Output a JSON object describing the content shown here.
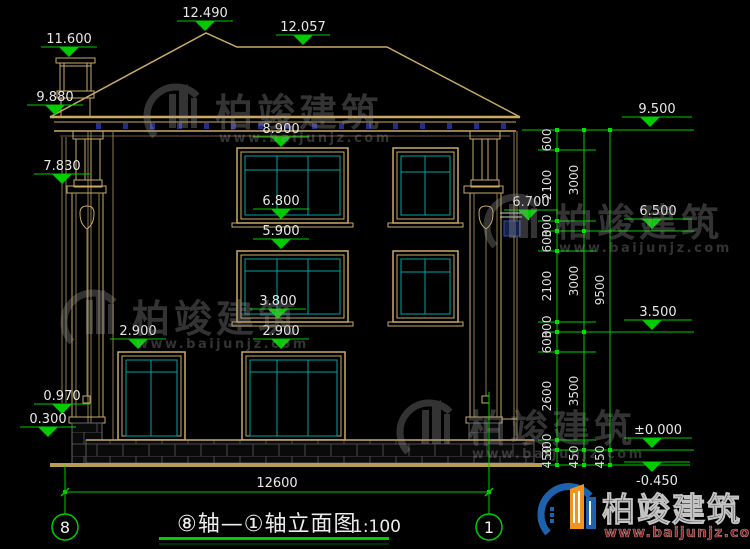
{
  "watermark": {
    "brand": "柏竣建筑",
    "url": "www.baijunjz.com"
  },
  "logo": {
    "brand": "柏竣建筑",
    "url": "www.baijunjz.com"
  },
  "title_block": {
    "title": "⑧轴—①轴立面图",
    "scale": "1:100"
  },
  "axes": {
    "left": "8",
    "right": "1"
  },
  "ground_dim": "12600",
  "levels": {
    "roof_peak": "12.490",
    "roof_ridge": "12.057",
    "chimney_top": "11.600",
    "eave_top": "9.880",
    "col_ledge": "7.830",
    "w3_top": "8.900",
    "w3_bottom": "6.800",
    "w2_top": "5.900",
    "w2_bottom": "3.800",
    "w1_top_left": "2.900",
    "w1_top_right": "2.900",
    "pier_cap": "0.970",
    "base_top": "0.300",
    "right_eave": "9.500",
    "right_ledge": "6.700",
    "right_mid": "6.500",
    "right_low": "3.500",
    "right_zero": "±0.000",
    "right_neg": "-0.450"
  },
  "dim_chains": {
    "inner": [
      "600",
      "2100",
      "300",
      "600",
      "2100",
      "300",
      "600",
      "2600",
      "300",
      "450"
    ],
    "middle": [
      "3000",
      "3000",
      "3500",
      "450"
    ],
    "outer": [
      "9500",
      "450"
    ]
  }
}
